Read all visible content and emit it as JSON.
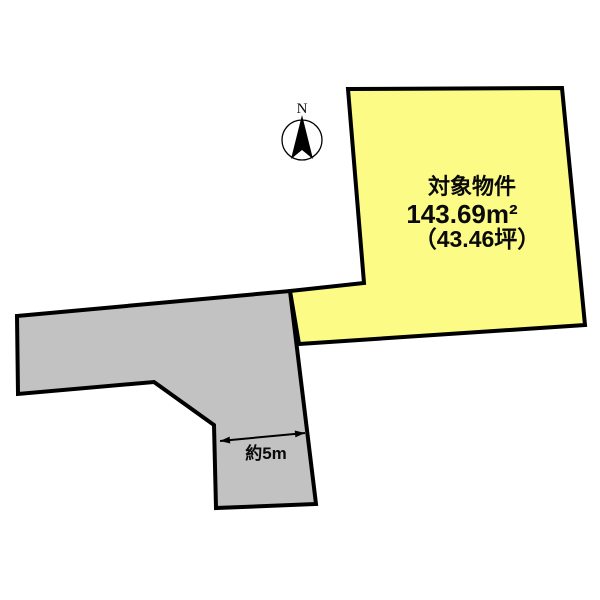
{
  "page": {
    "background": "#FFFFFF"
  },
  "compass": {
    "label": "N"
  },
  "property": {
    "title": "対象物件",
    "area": "143.69m²",
    "area_tsubo": "（43.46坪）"
  },
  "road": {
    "width_label": "約5m"
  },
  "colors": {
    "property_fill": "#FBFB86",
    "road_fill": "#C2C2C2",
    "outline": "#000000"
  }
}
